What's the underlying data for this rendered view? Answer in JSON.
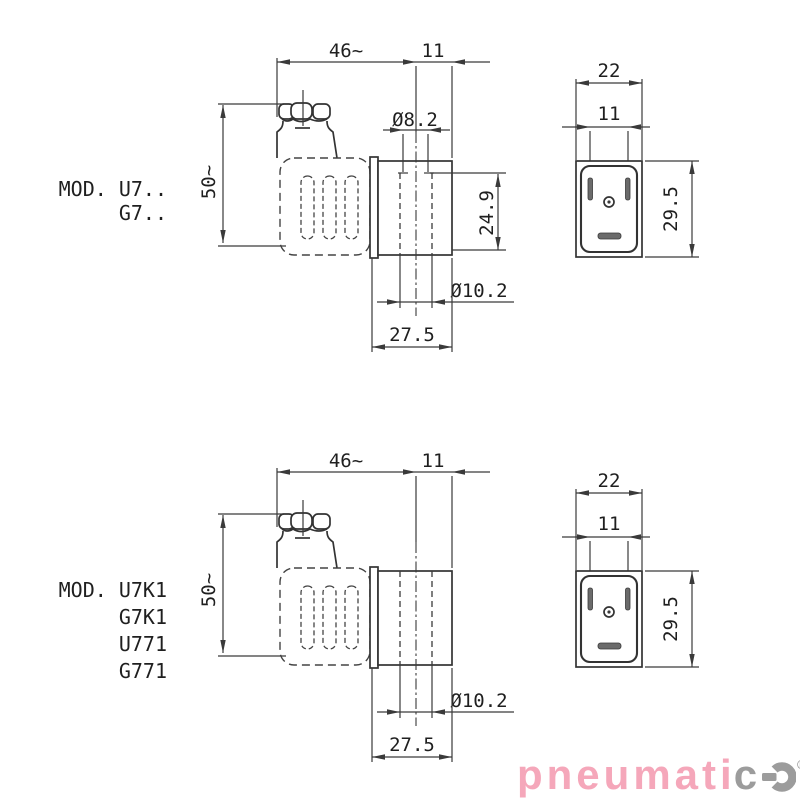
{
  "drawings": {
    "top": {
      "model_lines": {
        "line1": "MOD. U7..",
        "line2": "G7.."
      },
      "dims": {
        "overall_length": "46~",
        "face_offset": "11",
        "overall_height": "50~",
        "hole_diameter_small": "Ø8.2",
        "hole_depth": "24.9",
        "hole_diameter_large": "Ø10.2",
        "body_width": "27.5",
        "connector_width": "22",
        "pin_spacing": "11",
        "connector_height": "29.5"
      }
    },
    "bottom": {
      "model_lines": {
        "line1": "MOD. U7K1",
        "line2": "G7K1",
        "line3": "U771",
        "line4": "G771"
      },
      "dims": {
        "overall_length": "46~",
        "face_offset": "11",
        "overall_height": "50~",
        "hole_diameter_large": "Ø10.2",
        "body_width": "27.5",
        "connector_width": "22",
        "pin_spacing": "11",
        "connector_height": "29.5"
      }
    }
  },
  "logo": {
    "text_pink": "pneumati",
    "text_gray": "c",
    "registered_mark": "®",
    "pink_color": "#f5a7ba",
    "gray_color": "#9c9c9c"
  },
  "colors": {
    "line": "#333333",
    "background": "#ffffff"
  }
}
